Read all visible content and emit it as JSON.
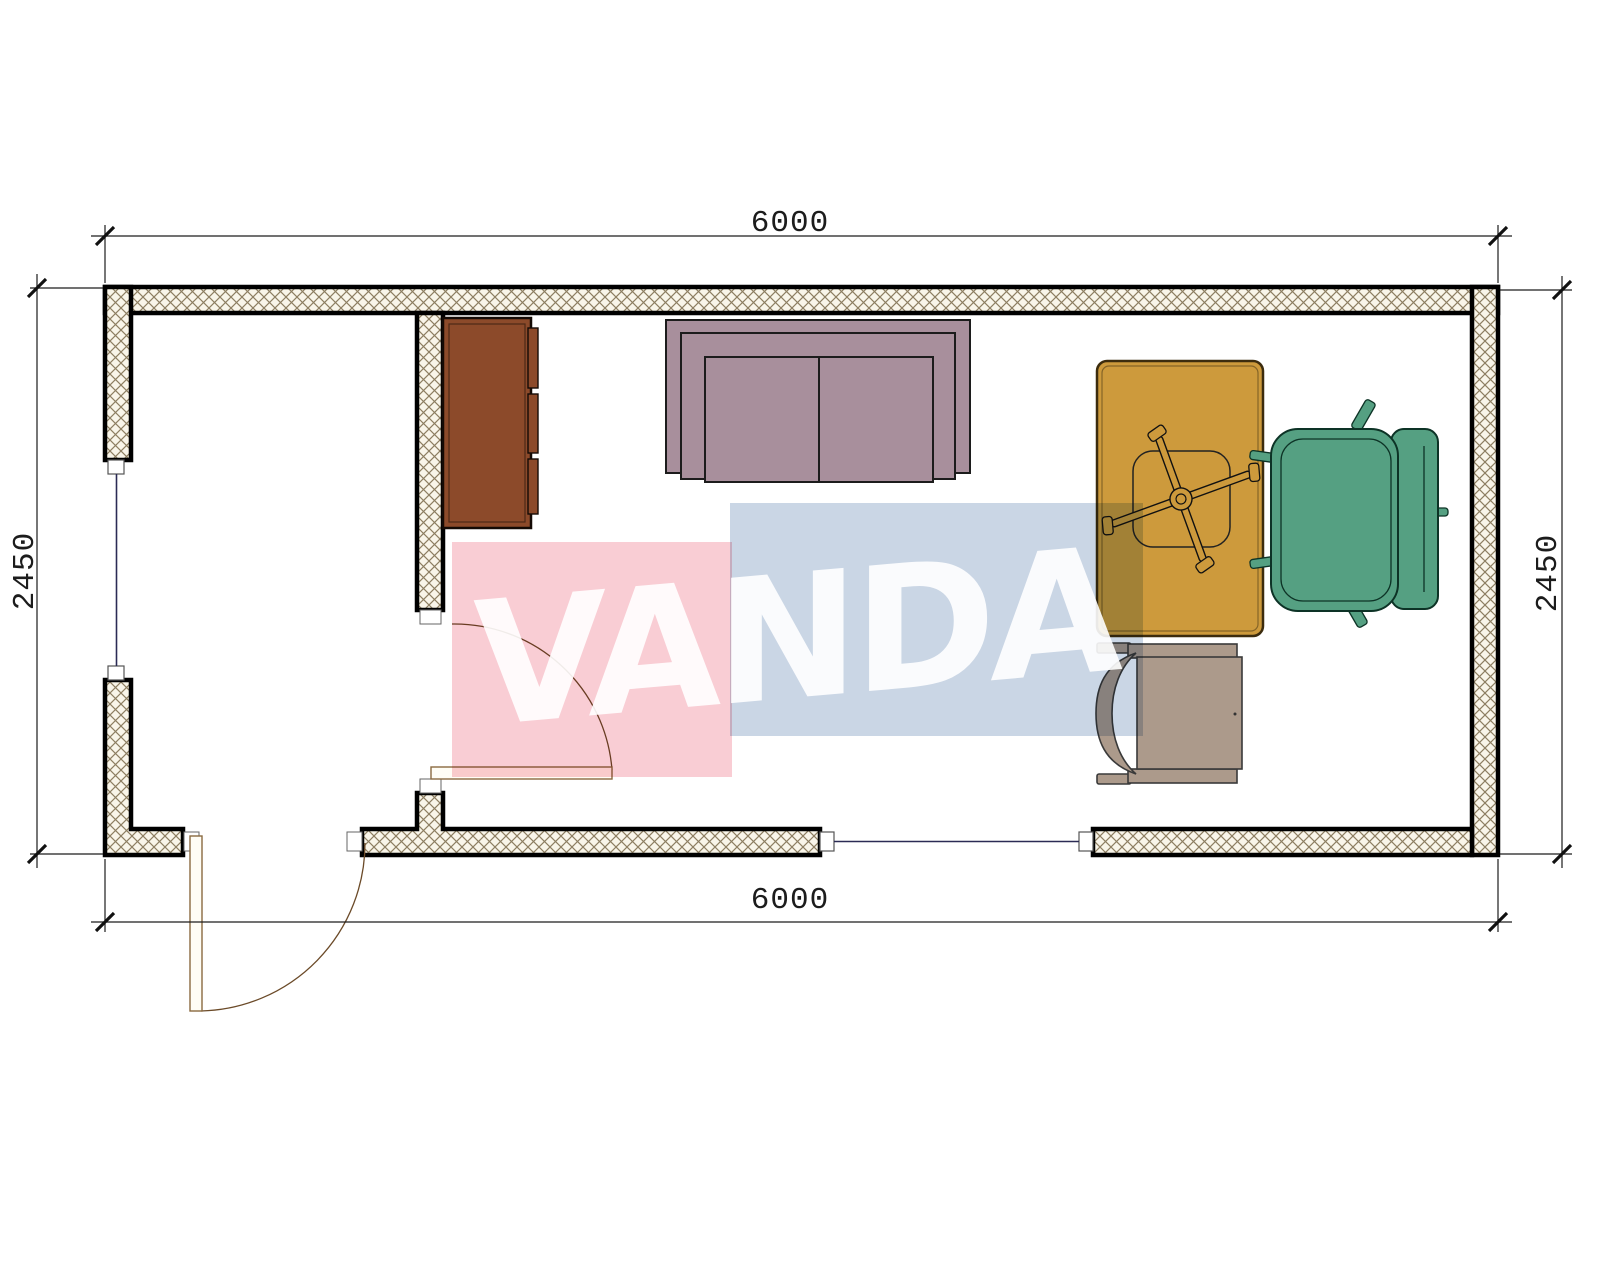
{
  "drawing": {
    "title": "floor-plan-6000x2450",
    "dimensions": {
      "top": "6000",
      "bottom": "6000",
      "left": "2450",
      "right": "2450"
    },
    "watermark": {
      "text": "VANDA",
      "pink_color": "#f9cdd4",
      "blue_color": "#cad6e5",
      "text_color": "#ffffff"
    },
    "colors": {
      "wall_outline": "#000000",
      "wall_hatch_background": "#f9f5e9",
      "wall_hatch_line": "#8d7e61",
      "window_line": "#2b2b55",
      "door_line": "#7a5c35",
      "dimension_line": "#1c1c1c"
    },
    "furniture": [
      {
        "name": "cabinet",
        "color": "#8c4a2a"
      },
      {
        "name": "sofa",
        "color": "#a88f9c"
      },
      {
        "name": "desk",
        "color": "#cd9a3c"
      },
      {
        "name": "desk-chair-base",
        "color": "#111111"
      },
      {
        "name": "armchair",
        "color": "#55a082"
      },
      {
        "name": "side-chair",
        "color": "#ac9a8b"
      }
    ]
  }
}
